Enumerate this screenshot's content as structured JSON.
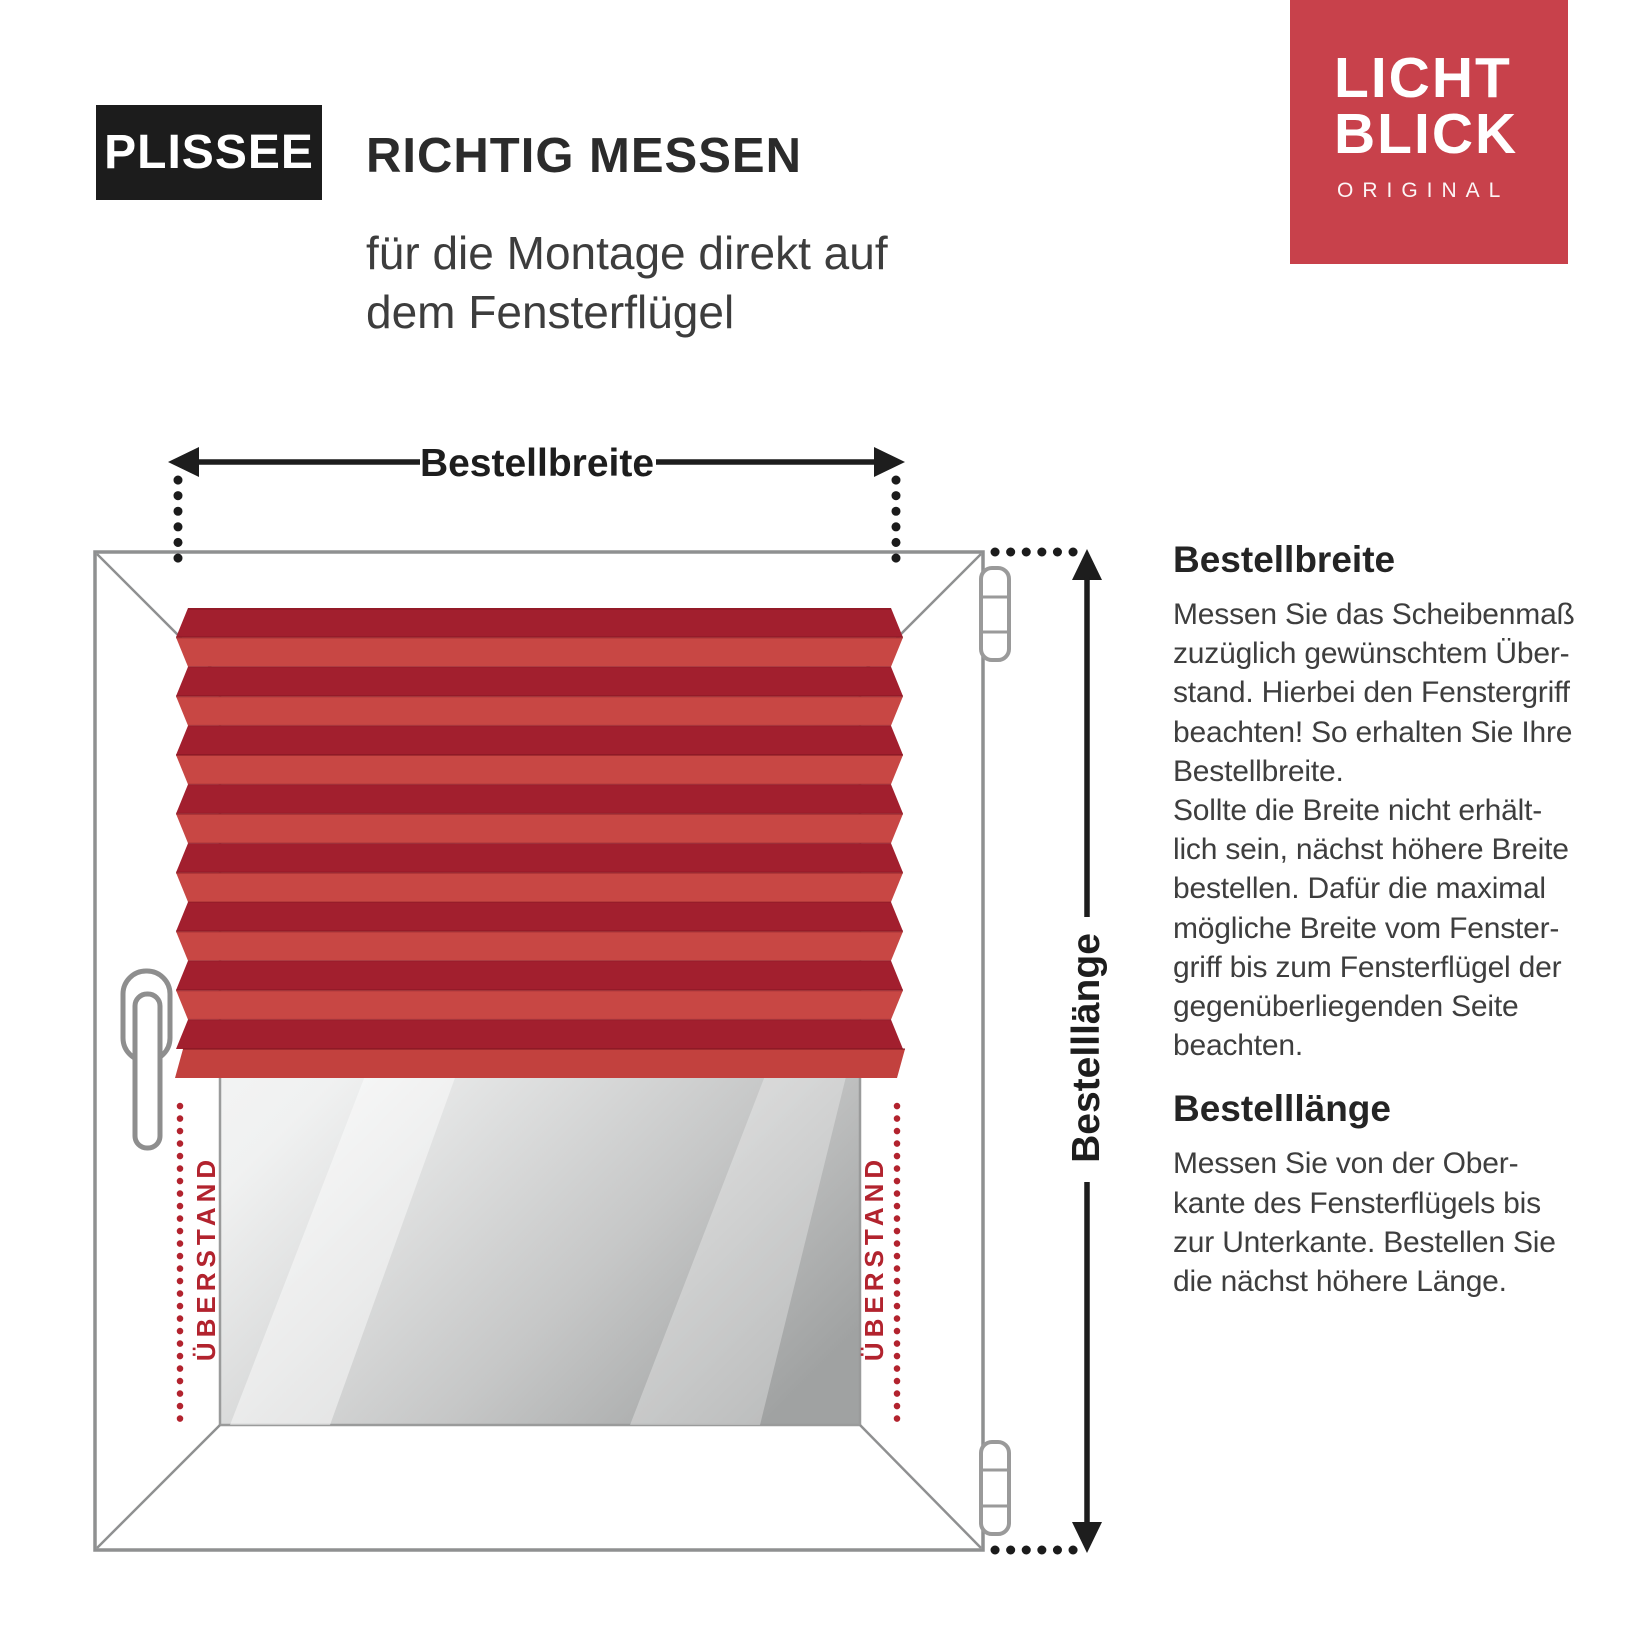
{
  "header": {
    "badge": "PLISSEE",
    "title": "RICHTIG MESSEN",
    "subtitle_line1": "für die Montage direkt auf",
    "subtitle_line2": "dem Fensterflügel"
  },
  "logo": {
    "line1": "LICHT",
    "line2": "BLICK",
    "tagline": "ORIGINAL",
    "bg_color": "#C8414B"
  },
  "diagram": {
    "width_arrow_label": "Bestellbreite",
    "length_arrow_label": "Bestelllänge",
    "overhang_left": "ÜBERSTAND",
    "overhang_right": "ÜBERSTAND",
    "colors": {
      "pleat_dark": "#A21F2E",
      "pleat_light": "#C84744",
      "rail_red": "#C2413E",
      "overhang_red": "#B2232E",
      "frame_gray": "#8F9091",
      "arrow_black": "#1D1D1D",
      "glass_dark": "#A0A2A2"
    }
  },
  "sections": [
    {
      "heading": "Bestellbreite",
      "lines": [
        "Messen Sie das Scheibenmaß",
        "zuzüglich gewünschtem Über-",
        "stand. Hierbei den Fenstergriff",
        "beachten! So erhalten Sie Ihre",
        "Bestellbreite.",
        "Sollte die Breite nicht erhält-",
        "lich sein, nächst höhere Breite",
        "bestellen. Dafür die maximal",
        "mögliche Breite vom Fenster-",
        "griff bis zum Fensterflügel der",
        "gegenüberliegenden Seite",
        "beachten."
      ]
    },
    {
      "heading": "Bestelllänge",
      "lines": [
        "Messen Sie von der Ober-",
        "kante des Fensterflügels bis",
        "zur Unterkante. Bestellen Sie",
        "die nächst höhere Länge."
      ]
    }
  ]
}
